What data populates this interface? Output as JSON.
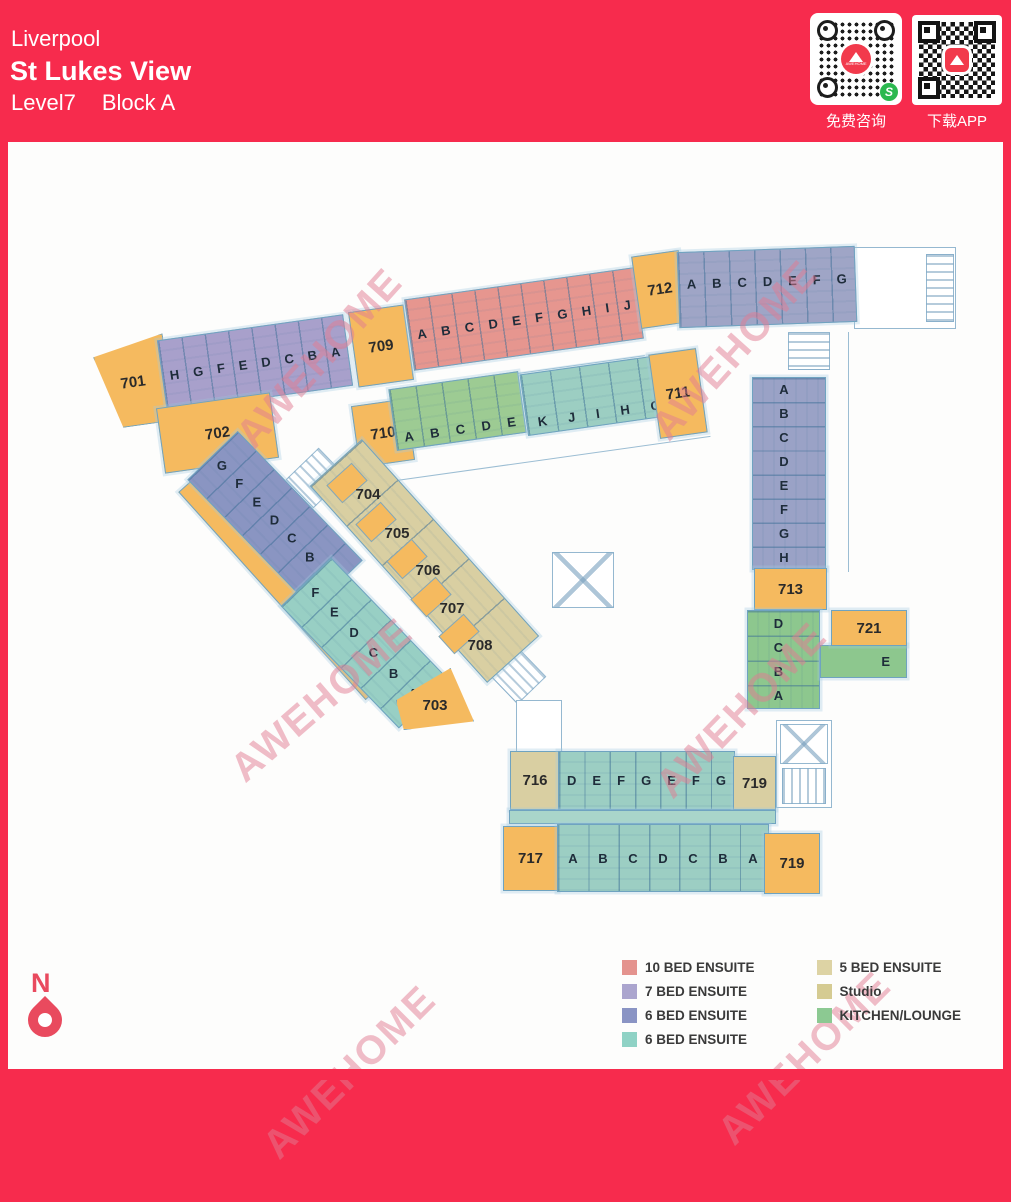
{
  "header": {
    "city": "Liverpool",
    "building": "St Lukes View",
    "level": "Level7",
    "block": "Block A",
    "bg_color": "#F72B4D"
  },
  "qr": {
    "left_caption": "免费咨询",
    "right_caption": "下载APP",
    "logo_text": "AWEHOME",
    "wechat_glyph": "S"
  },
  "watermark": {
    "text": "AWEHOME"
  },
  "north": {
    "label": "N"
  },
  "plan": {
    "flats": {
      "f701": {
        "number": "701",
        "rooms": [
          "H",
          "G",
          "F",
          "E",
          "D",
          "C",
          "B",
          "A"
        ]
      },
      "f702": {
        "number": "702",
        "rooms": [
          "G",
          "F",
          "E",
          "D",
          "C",
          "B",
          "A"
        ]
      },
      "f703": {
        "number": "703",
        "rooms": [
          "F",
          "E",
          "D",
          "C",
          "B",
          "A"
        ]
      },
      "f704": {
        "number": "704"
      },
      "f705": {
        "number": "705"
      },
      "f706": {
        "number": "706"
      },
      "f707": {
        "number": "707"
      },
      "f708": {
        "number": "708"
      },
      "f709": {
        "number": "709",
        "rooms": [
          "A",
          "B",
          "C",
          "D",
          "E",
          "F",
          "G",
          "H",
          "I",
          "J"
        ]
      },
      "f710": {
        "number": "710",
        "rooms": [
          "A",
          "B",
          "C",
          "D",
          "E"
        ]
      },
      "f711": {
        "number": "711",
        "rooms": [
          "K",
          "J",
          "I",
          "H",
          "G",
          "F"
        ]
      },
      "f712": {
        "number": "712",
        "rooms": [
          "A",
          "B",
          "C",
          "D",
          "E",
          "F",
          "G"
        ]
      },
      "f713": {
        "number": "713",
        "rooms": [
          "A",
          "B",
          "C",
          "D",
          "E",
          "F",
          "G",
          "H"
        ]
      },
      "f716": {
        "number": "716"
      },
      "f717": {
        "number": "717"
      },
      "f719_top": {
        "number": "719"
      },
      "f719_bottom": {
        "number": "719"
      },
      "f721": {
        "number": "721",
        "rooms": [
          "D",
          "C",
          "B",
          "A"
        ],
        "wing_room": "E"
      }
    },
    "bottom_band": {
      "top_rooms": [
        "D",
        "E",
        "F",
        "G",
        "E",
        "F",
        "G"
      ],
      "bottom_rooms": [
        "A",
        "B",
        "C",
        "D",
        "C",
        "B",
        "A"
      ]
    }
  },
  "legend": {
    "columns": [
      [
        {
          "color": "#E4938E",
          "label": "10 BED ENSUITE"
        },
        {
          "color": "#ABA5CE",
          "label": "7 BED ENSUITE"
        },
        {
          "color": "#8A94C4",
          "label": "6 BED ENSUITE"
        },
        {
          "color": "#8FD2C5",
          "label": "6 BED ENSUITE"
        }
      ],
      [
        {
          "color": "#DDD3A4",
          "label": "5 BED ENSUITE"
        },
        {
          "color": "#D5CB92",
          "label": "Studio"
        },
        {
          "color": "#8CC992",
          "label": "KITCHEN/LOUNGE"
        }
      ]
    ]
  }
}
